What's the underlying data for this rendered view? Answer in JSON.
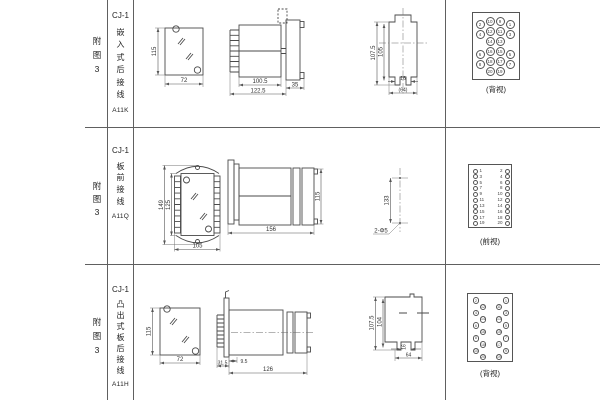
{
  "rows": [
    {
      "fig_label": [
        "附",
        "图",
        "3"
      ],
      "model": "CJ-1",
      "mount_chars": [
        "嵌",
        "入",
        "式",
        "后",
        "接",
        "线"
      ],
      "code": "A11K",
      "dims": {
        "cutout_h": "115",
        "cutout_w": "72",
        "body_w": "100.5",
        "overall_w": "122.5",
        "flange_w": "35",
        "rear_h1": "107.5",
        "rear_h2": "105",
        "rear_gap": "16",
        "rear_w": "(64)"
      },
      "terminal": {
        "label": "(背视)",
        "grid": [
          [
            "2",
            "10",
            "9",
            "1"
          ],
          [
            "4",
            "12",
            "11",
            "3"
          ],
          [
            "",
            "14",
            "13",
            ""
          ],
          [
            "6",
            "16",
            "15",
            "5"
          ],
          [
            "8",
            "18",
            "17",
            "7"
          ],
          [
            "",
            "20",
            "19",
            ""
          ]
        ]
      }
    },
    {
      "fig_label": [
        "附",
        "图",
        "3"
      ],
      "model": "CJ-1",
      "mount_chars": [
        "板",
        "前",
        "接",
        "线"
      ],
      "code": "A11Q",
      "dims": {
        "front_h1": "149",
        "front_h2": "125",
        "front_w": "105",
        "side_len": "156",
        "side_h": "115",
        "hole_span": "133",
        "hole_note": "2-Φ5"
      },
      "terminal": {
        "label": "(前视)",
        "left": [
          "1",
          "3",
          "5",
          "7",
          "9",
          "11",
          "13",
          "15",
          "17",
          "19"
        ],
        "right": [
          "2",
          "4",
          "6",
          "8",
          "10",
          "12",
          "14",
          "16",
          "18",
          "20"
        ]
      }
    },
    {
      "fig_label": [
        "附",
        "图",
        "3"
      ],
      "model": "CJ-1",
      "mount_chars": [
        "凸",
        "出",
        "式",
        "板",
        "后",
        "接",
        "线"
      ],
      "code": "A11H",
      "dims": {
        "cutout_h": "115",
        "cutout_w": "72",
        "proj": "31.5",
        "stud": "9.5",
        "len": "126",
        "rear_h1": "107.5",
        "rear_h2": "104",
        "rear_gap": "16",
        "rear_w": "64"
      },
      "terminal": {
        "label": "(背视)",
        "left_outer": [
          "2",
          "4",
          "6",
          "8",
          "10"
        ],
        "left_inner": [
          "12",
          "14",
          "16",
          "18",
          "20"
        ],
        "right_inner": [
          "11",
          "13",
          "15",
          "17",
          "19"
        ],
        "right_outer": [
          "1",
          "3",
          "5",
          "7",
          "9"
        ]
      }
    }
  ]
}
